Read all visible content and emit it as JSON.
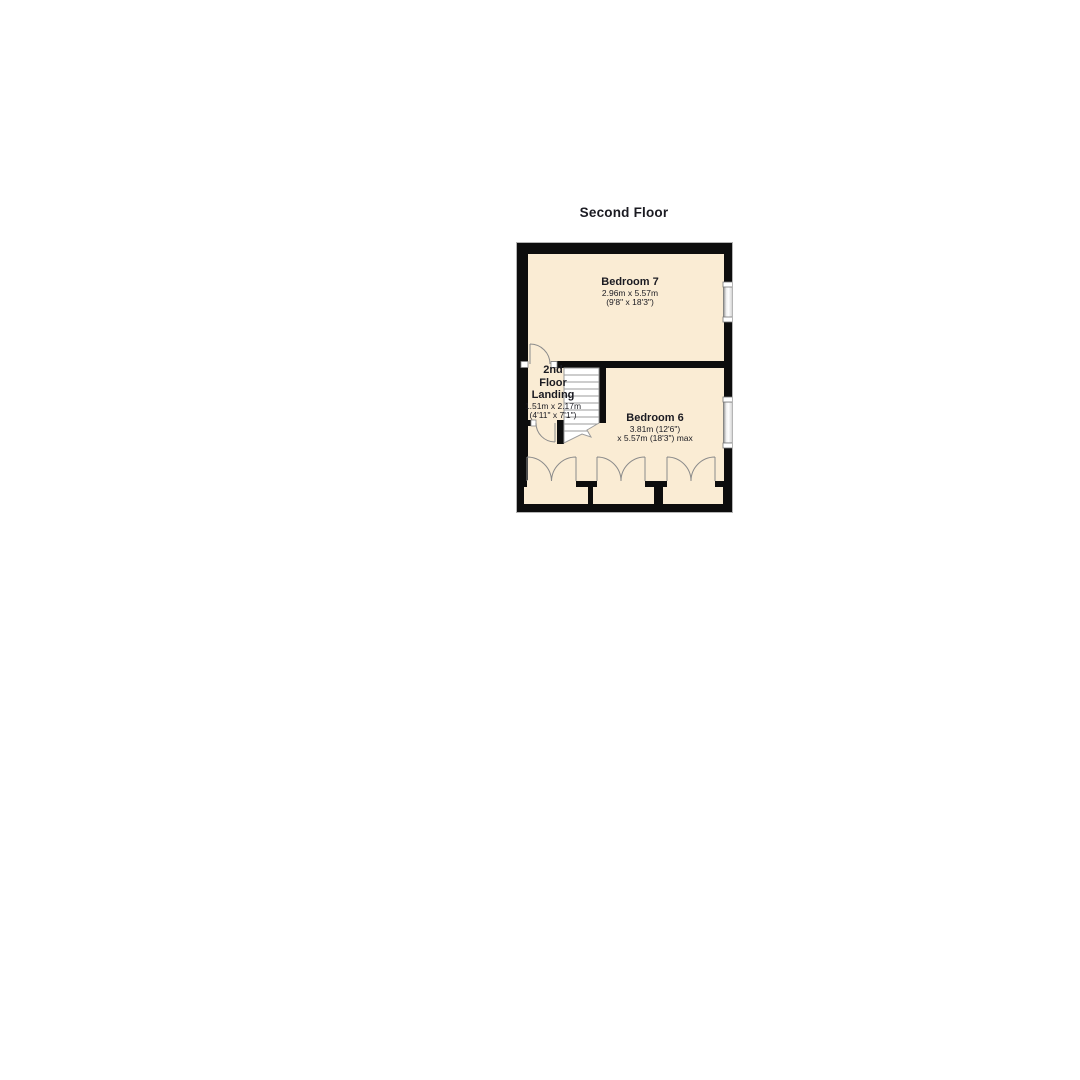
{
  "title": "Second Floor",
  "colors": {
    "floor": "#faecd4",
    "wall": "#0d0d0d",
    "outline": "#b5b5b5",
    "stair": "#ffffff",
    "stair_line": "#9b9b9b",
    "arc": "#8b8b8b",
    "window": "#e2e2e2",
    "text": "#1b1b22"
  },
  "rooms": {
    "bedroom7": {
      "name": "Bedroom 7",
      "dim_metric": "2.96m x 5.57m",
      "dim_imperial": "(9'8\" x 18'3\")"
    },
    "bedroom6": {
      "name": "Bedroom 6",
      "dim_line1": "3.81m (12'6\")",
      "dim_line2": "x 5.57m (18'3\") max"
    },
    "landing": {
      "name_line1": "2nd",
      "name_line2": "Floor",
      "name_line3": "Landing",
      "dim_metric": "1.51m x 2.17m",
      "dim_imperial": "(4'11\" x 7'1\")"
    }
  }
}
